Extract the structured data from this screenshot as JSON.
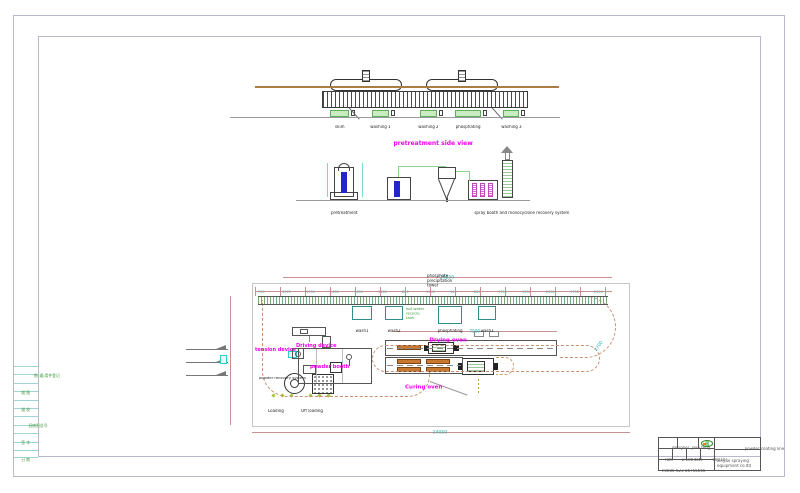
{
  "side_view": {
    "title": "pretreatment side view",
    "tanks": [
      "skim",
      "washing 1",
      "washing 2",
      "phosphating",
      "washing 3"
    ]
  },
  "elevation": {
    "pretreatment": "pretreatment",
    "spray_system": "spray booth and monocyclone recovery system"
  },
  "plan": {
    "overall_dim_top": "24050",
    "overall_dim_bottom": "24050",
    "drying_dim": "7500",
    "curve_dim": "2700",
    "segment_dims": [
      "700",
      "1570",
      "1700",
      "2000",
      "1650",
      "1600",
      "800",
      "1943",
      "140",
      "800",
      "1700",
      "1250",
      "2000",
      "1795",
      "2200"
    ],
    "tower_note": "phosphate\nprecipitation\ntower",
    "recycle_note": "hot water\nrecycle\ntank",
    "tanks": [
      "wash1",
      "wash2",
      "phosphating",
      "wash3"
    ],
    "tension_device": "tension device",
    "driving_device": "Driving device",
    "powder_booth": "powder booth",
    "powder_recovery": "powder recovery system",
    "drying_oven": "Drying oven",
    "curing_oven": "Curing oven",
    "loading": "Loading",
    "off_loading": "Off loading"
  },
  "left_strip": {
    "cells": [
      "借(通)用件登记",
      "描 图",
      "描 校",
      "旧底图总号",
      "签 字",
      "日 期"
    ]
  },
  "title_block": {
    "designer_label": "designer",
    "designer_value": "jake feng",
    "scale_label": "rate",
    "scale_value": "1:100",
    "date_label": "date",
    "date_value": "080107",
    "phone": "T:0086-523-86755666",
    "project": "powder coating line",
    "company_line1": "xinyue spraying",
    "company_line2": "equipment co.ltd"
  },
  "colors": {
    "accent_magenta": "#f000f0",
    "dim_cyan": "#21b0b0",
    "dim_rose": "#c89090",
    "loop_dash": "#c89070",
    "tank_green": "#c9ecc0",
    "frame": "#b6bacc",
    "burner_orange": "#c87830",
    "booth_blue": "#2525cc",
    "duct_green": "#8fd08f"
  }
}
